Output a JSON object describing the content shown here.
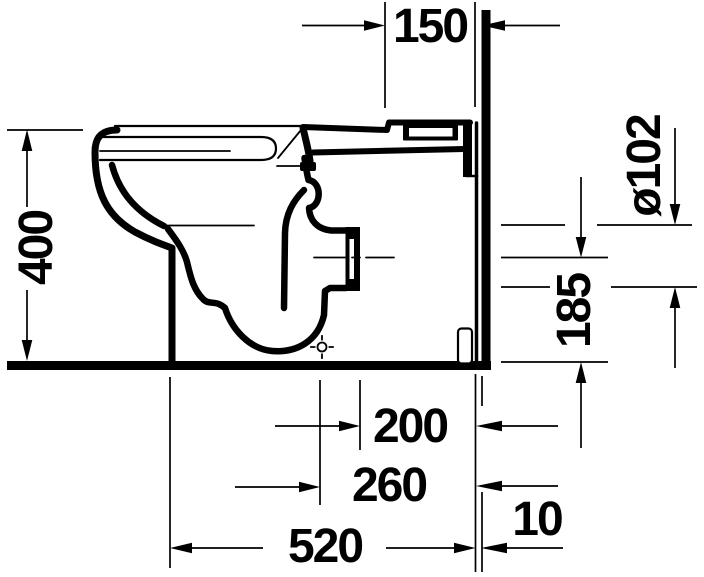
{
  "figure": {
    "subject": "Floor-standing toilet, side section technical drawing with wall and floor datum lines",
    "type": "technical-dimension-drawing"
  },
  "colors": {
    "ink": "#000000",
    "background": "#ffffff"
  },
  "dimensions": [
    {
      "id": "top-offset",
      "text": "150",
      "orientation": "horizontal"
    },
    {
      "id": "rim-height",
      "text": "400",
      "orientation": "vertical"
    },
    {
      "id": "outlet-diameter",
      "text": "ø102",
      "orientation": "vertical"
    },
    {
      "id": "outlet-center-height",
      "text": "185",
      "orientation": "vertical"
    },
    {
      "id": "outlet-depth",
      "text": "200",
      "orientation": "horizontal"
    },
    {
      "id": "trap-depth",
      "text": "260",
      "orientation": "horizontal"
    },
    {
      "id": "total-depth",
      "text": "520",
      "orientation": "horizontal"
    },
    {
      "id": "wall-gap",
      "text": "10",
      "orientation": "horizontal"
    }
  ]
}
